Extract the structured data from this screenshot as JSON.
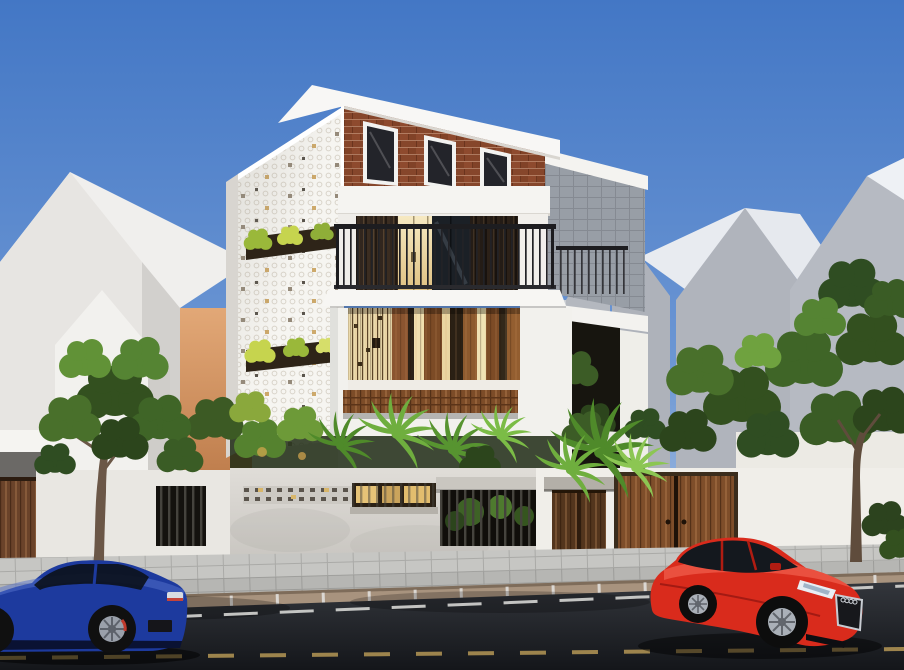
{
  "scene": {
    "kind": "3d-architectural-exterior-render",
    "description": "Modern three-storey townhouse with slanted white skillion roof, red brick gable with three dark windows, white perforated screen facade with two planter slots, black balcony railing over glass doors with brown curtains, timber louver screen on the second floor, grey granite side volume, white street fence with timber gates and barred openings, street-side trees and palms, paved sidewalk, asphalt road with dashed lane markings, a dark blue sedan parked at the left and a red sedan at the right, under a clear blue sky with grey gabled neighbour houses"
  },
  "counts": {
    "gable_windows": 3,
    "panel_planter_slots": 2,
    "fence_gates": 3,
    "fence_barred_openings": 2,
    "cars": 2,
    "street_trees": 2
  },
  "objects": {
    "roof": "white skillion roof slab",
    "brick_gable": "red brick gable wall",
    "gable_window": "dark window with white frame",
    "perforated_panel": "white perforated facade screen with planters",
    "balcony": "black steel railing balcony",
    "curtains": "dark brown curtains behind glass doors",
    "lit_door": "warm lit interior doorway",
    "louver_screen": "vertical timber louver screen",
    "planter_band": "horizontal timber planter cladding",
    "granite_volume": "grey granite-clad side volume",
    "frame_volume": "white frame volume with courtyard trees",
    "fence": "white concrete street fence",
    "left_gate": "dark timber gate (left, cropped)",
    "pedestrian_gate": "dark timber pedestrian gate with concrete lintel",
    "main_gate": "double timber entry gate",
    "blue_car": "dark blue sedan parked at kerb",
    "red_car": "red sedan on the road",
    "sidewalk": "grey paver sidewalk",
    "road": "asphalt road with dashed markings"
  },
  "palette": {
    "sky_top": "#4377c5",
    "sky_horizon": "#c3d5eb",
    "roof_white": "#f8f7f5",
    "brick": "#8e4a2e",
    "window_glass": "#1c2127",
    "curtain_brown": "#33271d",
    "warm_light": "#ecd9a0",
    "panel_white": "#f6f5f1",
    "railing_black": "#1d1d20",
    "louver_wood": "#8a5530",
    "louver_cream": "#f0dfae",
    "planter_wood": "#7c4c28",
    "granite_gray": "#a7acb4",
    "bg_house_light": "#e9e8e5",
    "bg_house_gray": "#b4b8bf",
    "warm_wall": "#d99a66",
    "fence_white": "#f0eee9",
    "fence_concrete": "#d8d5d0",
    "gate_wood": "#7e4e2a",
    "gate_wood_dark": "#53351d",
    "sidewalk": "#c6c6c3",
    "curb": "#a8937e",
    "asphalt": "#1c1f24",
    "road_mark_white": "#e0e0dd",
    "road_mark_center": "#b59755",
    "foliage_dark": "#33501f",
    "foliage_mid": "#49702b",
    "foliage_light": "#7fb04a",
    "palm_green": "#5f9a34",
    "trunk_brown": "#6b5747",
    "car_blue": "#1d3a9e",
    "car_red": "#d92b1c"
  }
}
